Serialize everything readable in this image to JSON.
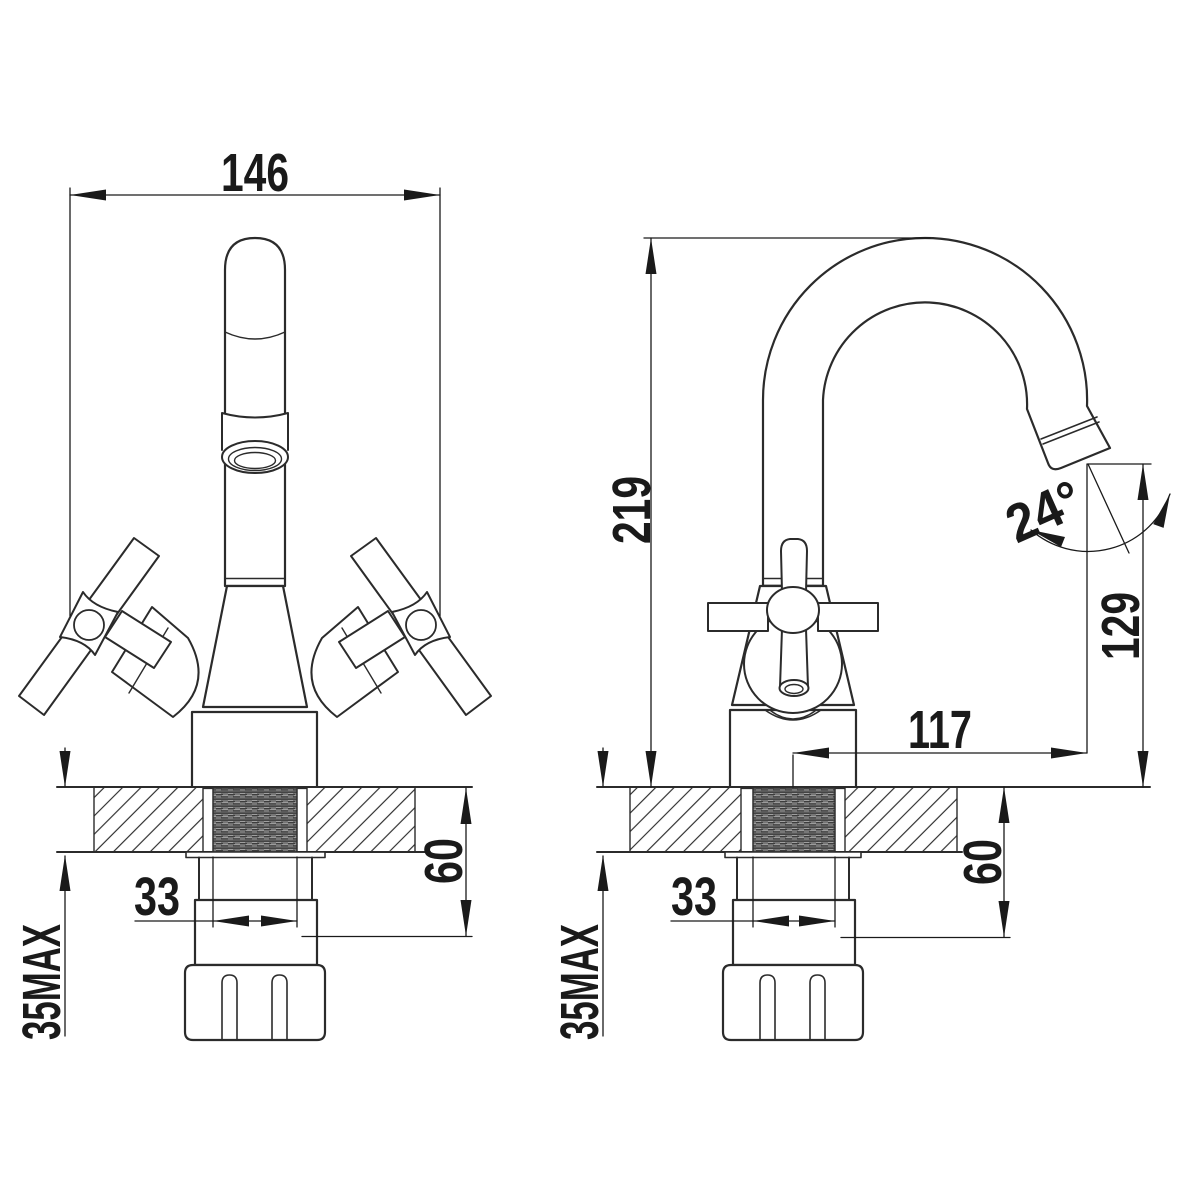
{
  "colors": {
    "background": "#ffffff",
    "line": "#2b2b2b",
    "dimension": "#1a1a1a",
    "thread_fill": "#777777"
  },
  "front_view": {
    "overall_width": "146",
    "thread_diameter": "33",
    "shank_length": "60",
    "max_deck_thickness": "35MAX"
  },
  "side_view": {
    "overall_height": "219",
    "spout_reach": "117",
    "outlet_height": "129",
    "outlet_angle": "24°",
    "thread_diameter": "33",
    "shank_length": "60",
    "max_deck_thickness": "35MAX"
  }
}
